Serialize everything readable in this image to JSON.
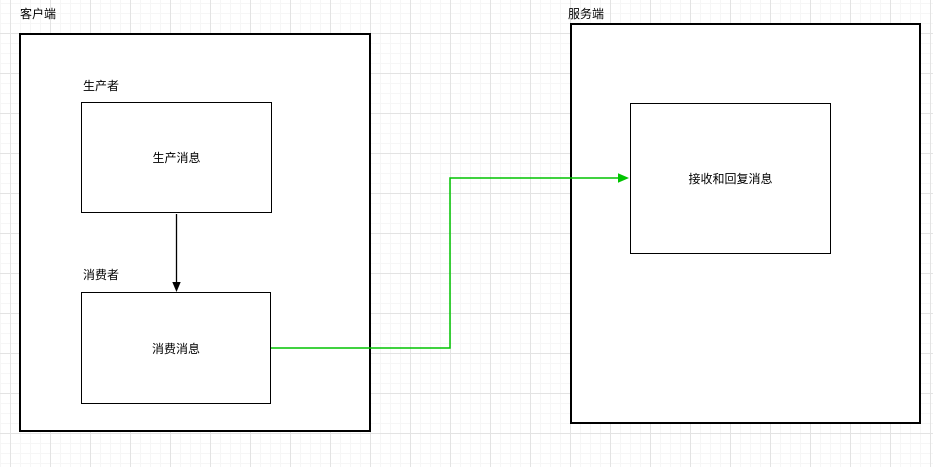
{
  "diagram": {
    "client": {
      "label": "客户端"
    },
    "server": {
      "label": "服务端"
    },
    "producer": {
      "label": "生产者",
      "node_text": "生产消息"
    },
    "consumer": {
      "label": "消费者",
      "node_text": "消费消息"
    },
    "server_node_text": "接收和回复消息"
  },
  "colors": {
    "connector_green": "#00c400",
    "stroke_black": "#000000",
    "grid_major": "#e3e3e3",
    "grid_minor": "#f6f6f6"
  }
}
